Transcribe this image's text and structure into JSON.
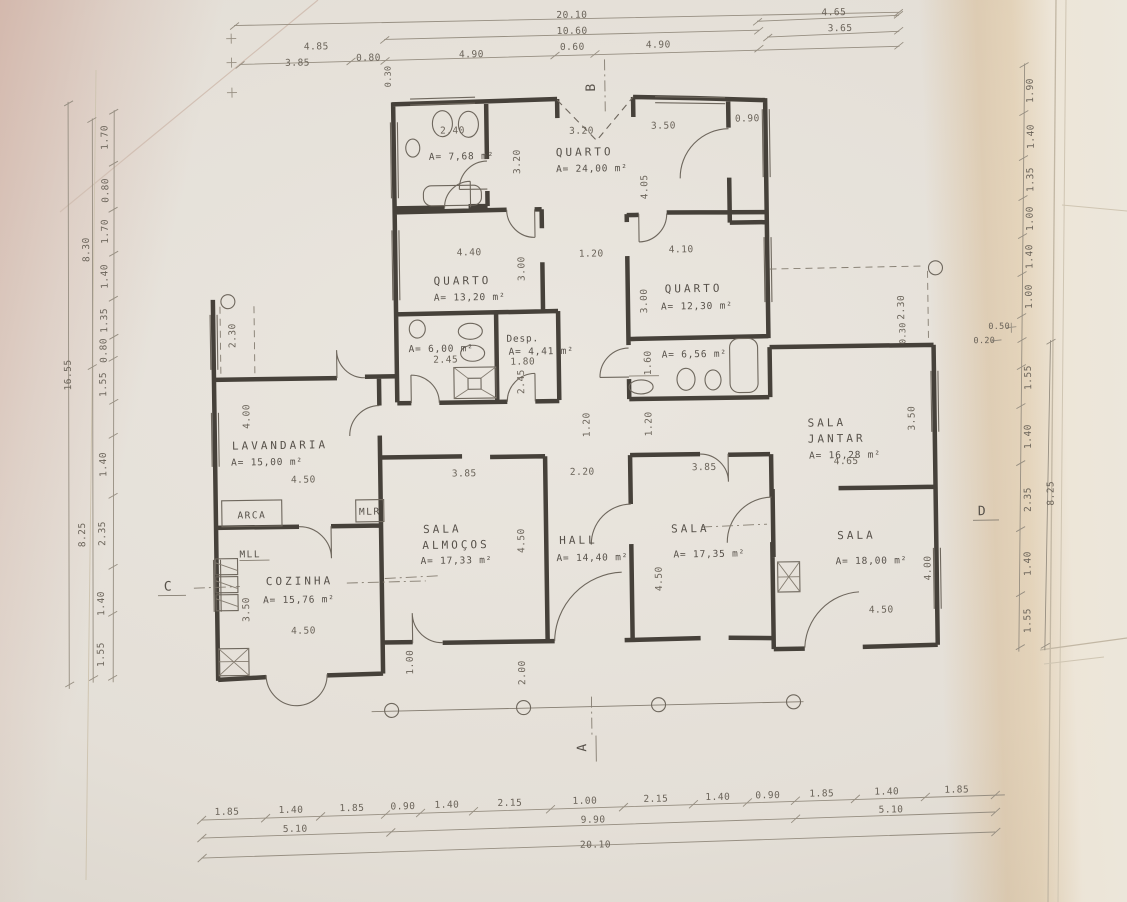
{
  "rooms": {
    "bath_top": {
      "area": "A= 7,68 m²"
    },
    "quarto_24": {
      "name": "QUARTO",
      "area": "A= 24,00 m²"
    },
    "quarto_13": {
      "name": "QUARTO",
      "area": "A= 13,20 m²"
    },
    "quarto_12": {
      "name": "QUARTO",
      "area": "A= 12,30 m²"
    },
    "bath_6": {
      "area": "A= 6,00 m²"
    },
    "desp": {
      "name": "Desp.",
      "area": "A= 4,41 m²"
    },
    "bath_656": {
      "area": "A= 6,56 m²"
    },
    "lavandaria": {
      "name": "LAVANDARIA",
      "area": "A= 15,00 m²"
    },
    "cozinha": {
      "name": "COZINHA",
      "area": "A= 15,76 m²"
    },
    "sala_almocos": {
      "line1": "SALA",
      "line2": "ALMOÇOS",
      "area": "A= 17,33 m²"
    },
    "hall": {
      "name": "HALL",
      "area": "A= 14,40 m²"
    },
    "sala_17": {
      "name": "SALA",
      "area": "A= 17,35 m²"
    },
    "sala_jantar": {
      "line1": "SALA",
      "line2": "JANTAR",
      "area": "A= 16,28 m²"
    },
    "sala_18": {
      "name": "SALA",
      "area": "A= 18,00 m²"
    }
  },
  "appliances": {
    "arca": "ARCA",
    "mlr": "MLR",
    "mll": "MLL"
  },
  "sections": {
    "a": "A",
    "b": "B",
    "c": "C",
    "d": "D"
  },
  "dims": {
    "top": {
      "total": "20.10",
      "sub": "10.60",
      "row": [
        "4.85",
        "3.85",
        "0.80",
        "4.90",
        "0.60",
        "4.90"
      ],
      "small": "0.30",
      "right1": "4.65",
      "right2": "3.65"
    },
    "bottom": {
      "row": [
        "1.85",
        "1.40",
        "1.85",
        "0.90",
        "1.40",
        "2.15",
        "1.00",
        "2.15",
        "1.40",
        "0.90",
        "1.85",
        "1.40",
        "1.85"
      ],
      "mid": [
        "5.10",
        "9.90",
        "5.10"
      ],
      "total": "20.10"
    },
    "left": {
      "col": [
        "1.70",
        "0.80",
        "1.70",
        "1.40",
        "1.35",
        "0.80",
        "1.55",
        "1.40",
        "2.35",
        "1.40",
        "1.55"
      ],
      "outer": "16.55",
      "mid1": "8.30",
      "mid2": "8.25"
    },
    "right": {
      "col": [
        "1.90",
        "1.40",
        "1.35",
        "1.00",
        "1.40",
        "1.00",
        "1.55",
        "1.40",
        "2.35",
        "1.40",
        "1.55"
      ],
      "mid": "8.25",
      "small1": "0.50",
      "small2": "0.20"
    },
    "inner": {
      "bath_top_w": "2.40",
      "q24_w": "3.20",
      "q24_h": "3.20",
      "tr_w": "3.50",
      "tr_door": "0.90",
      "tr_h": "4.05",
      "q13_w": "4.40",
      "q13_h": "3.00",
      "corridor_w": "1.20",
      "q12_w": "4.10",
      "q12_h": "3.00",
      "bath6_w": "2.45",
      "desp_w": "1.80",
      "desp_h": "2.45",
      "bath656_h": "1.60",
      "terrace_l_h": "2.30",
      "lav_h": "4.00",
      "lav_w": "4.50",
      "coz_h": "3.50",
      "coz_w": "4.50",
      "porch_l_h": "1.00",
      "sa_w": "3.85",
      "sa_h": "4.50",
      "hall_w": "2.20",
      "hall_h": "4.50",
      "s17_w": "3.85",
      "cor_l_h": "1.20",
      "cor_r_h": "1.20",
      "terrace_r_h": "2.30",
      "terrace_r_s": "0.30",
      "sj_h": "3.50",
      "sj_w": "4.65",
      "s18_h": "4.00",
      "s18_w": "4.50",
      "porch_h": "2.00"
    }
  }
}
